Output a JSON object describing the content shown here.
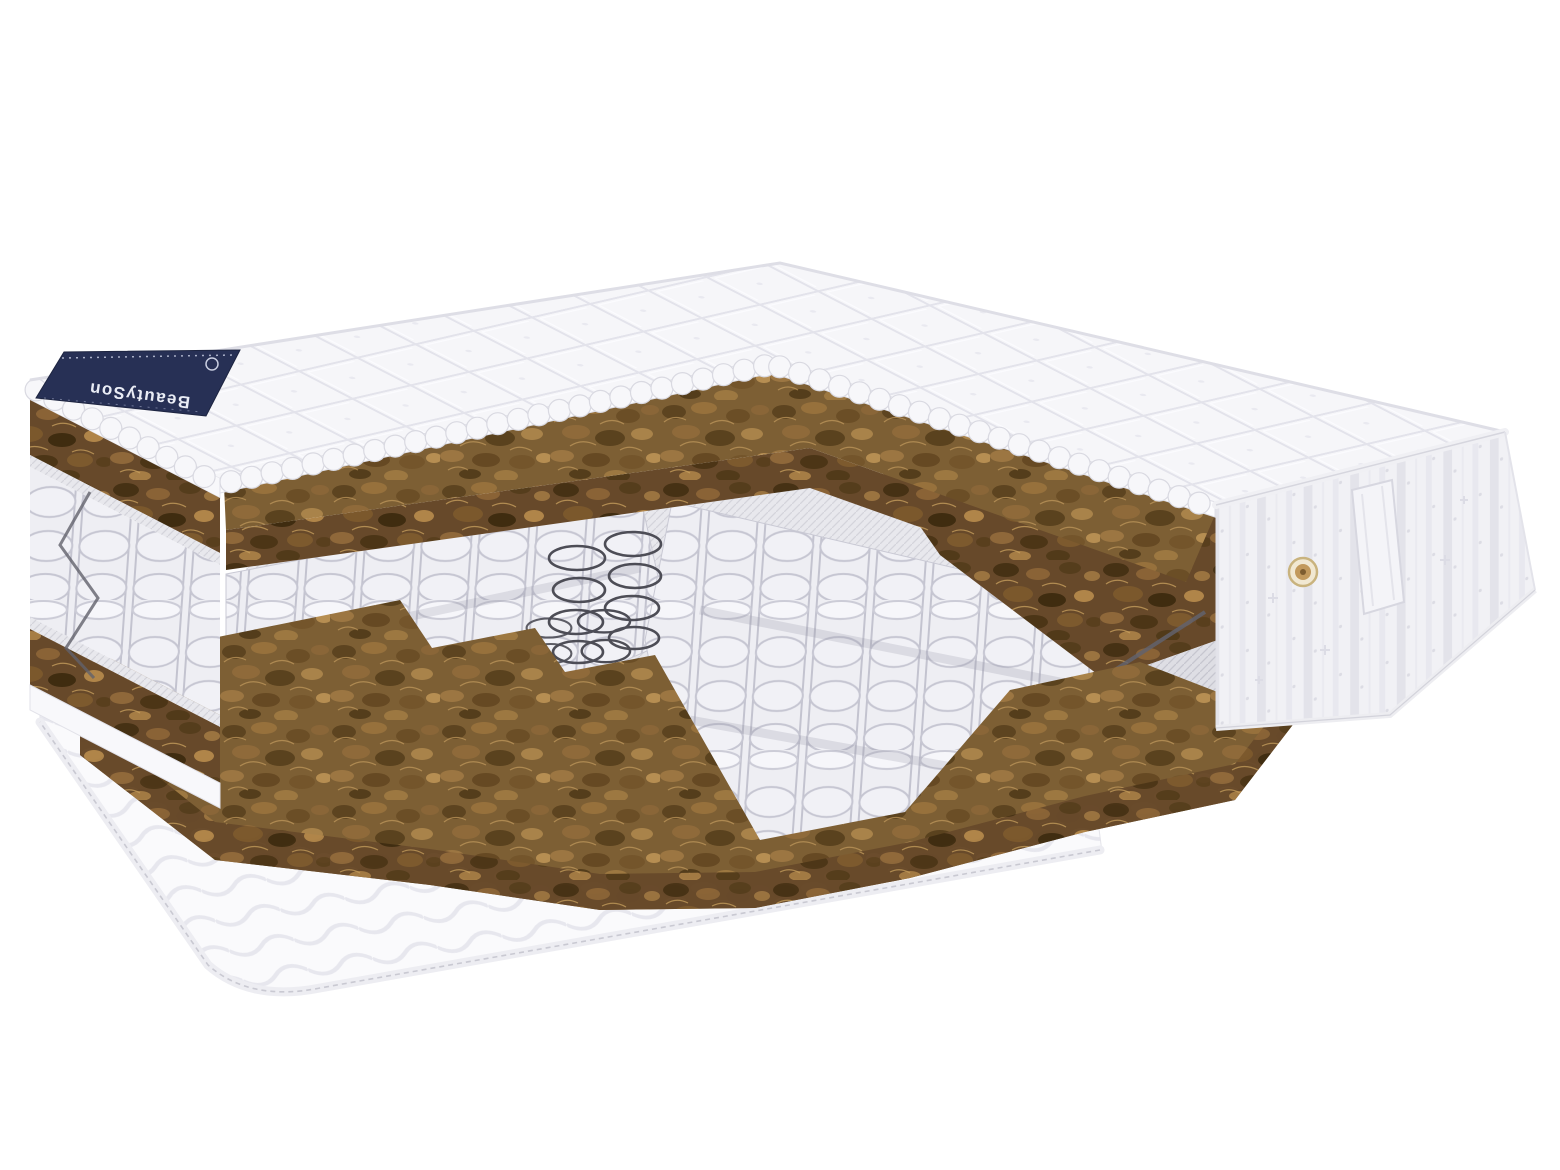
{
  "photo": {
    "alt": "Product photo of a double-sided mattress with a stepped cutaway corner revealing two brown coconut coir layers and a white pocketed coil spring core, navy brand tag on the far corner, quilted side panel with fabric handle and gold air vent, on a white background"
  },
  "brand_tag": {
    "text": "BeautySon"
  },
  "colors": {
    "page_bg": "#ffffff",
    "quilt_white": "#f6f6f9",
    "quilt_line": "#e3e3eb",
    "coir_brown": "#7d5f34",
    "coir_dark": "#5c4420",
    "coir_light": "#a9834a",
    "mesh_gray": "#e8e8ed",
    "spring_fabric": "#eeeef3",
    "spring_outline": "#c6c6d1",
    "coil_wire": "#4d4d56",
    "border_wire": "#62626c",
    "tag_navy": "#273055",
    "tag_text": "#e9ecf5",
    "vent_gold": "#c2995c",
    "piping": "#ededf2"
  }
}
